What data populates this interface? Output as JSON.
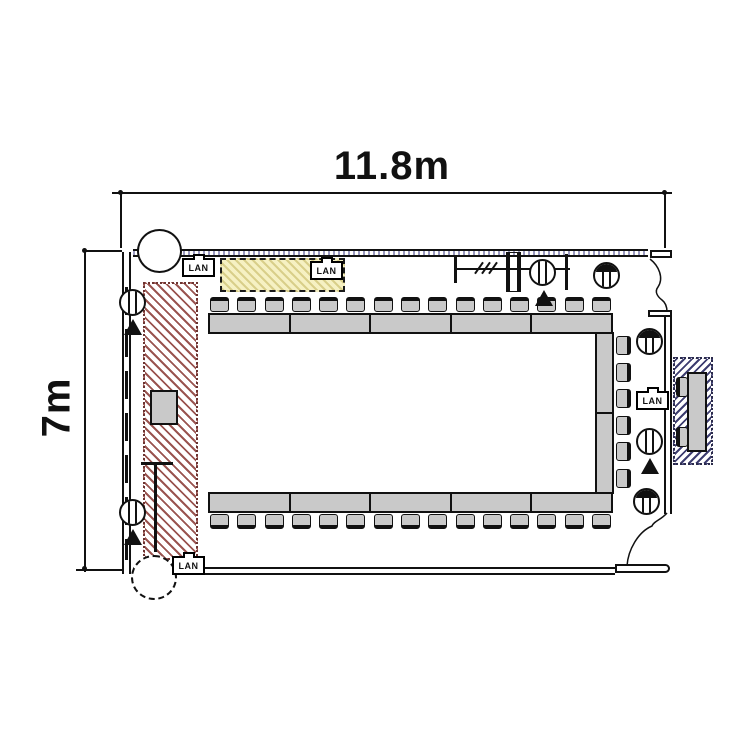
{
  "diagram": {
    "kind": "meeting-room floor plan",
    "dimensions": {
      "width_label": "11.8m",
      "height_label": "7m"
    },
    "lan_label": "LAN",
    "lan_ports": [
      "top-left wall",
      "screen zone",
      "right wall",
      "bottom-left wall"
    ],
    "furniture": {
      "top_table_segments": 5,
      "bottom_table_segments": 5,
      "right_table_segments": 2,
      "top_chairs": 15,
      "bottom_chairs": 15,
      "right_chairs": 6,
      "booth_chairs": 2,
      "podium_count": 1
    },
    "symbols": {
      "floor_outlets_with_arrow": 4,
      "wall_outlets_filled": 3,
      "columns": 2,
      "door_openings": 2
    },
    "colors": {
      "furniture_fill": "#c9c9c9",
      "line": "#111111",
      "presenter_zone_hatch": "#9a5450",
      "screen_zone_fill": "#f6f1c3",
      "screen_zone_hatch": "#d9cf8a",
      "booth_hatch": "#3d3d70",
      "top_wall_dots": "#9a9ac0"
    }
  }
}
